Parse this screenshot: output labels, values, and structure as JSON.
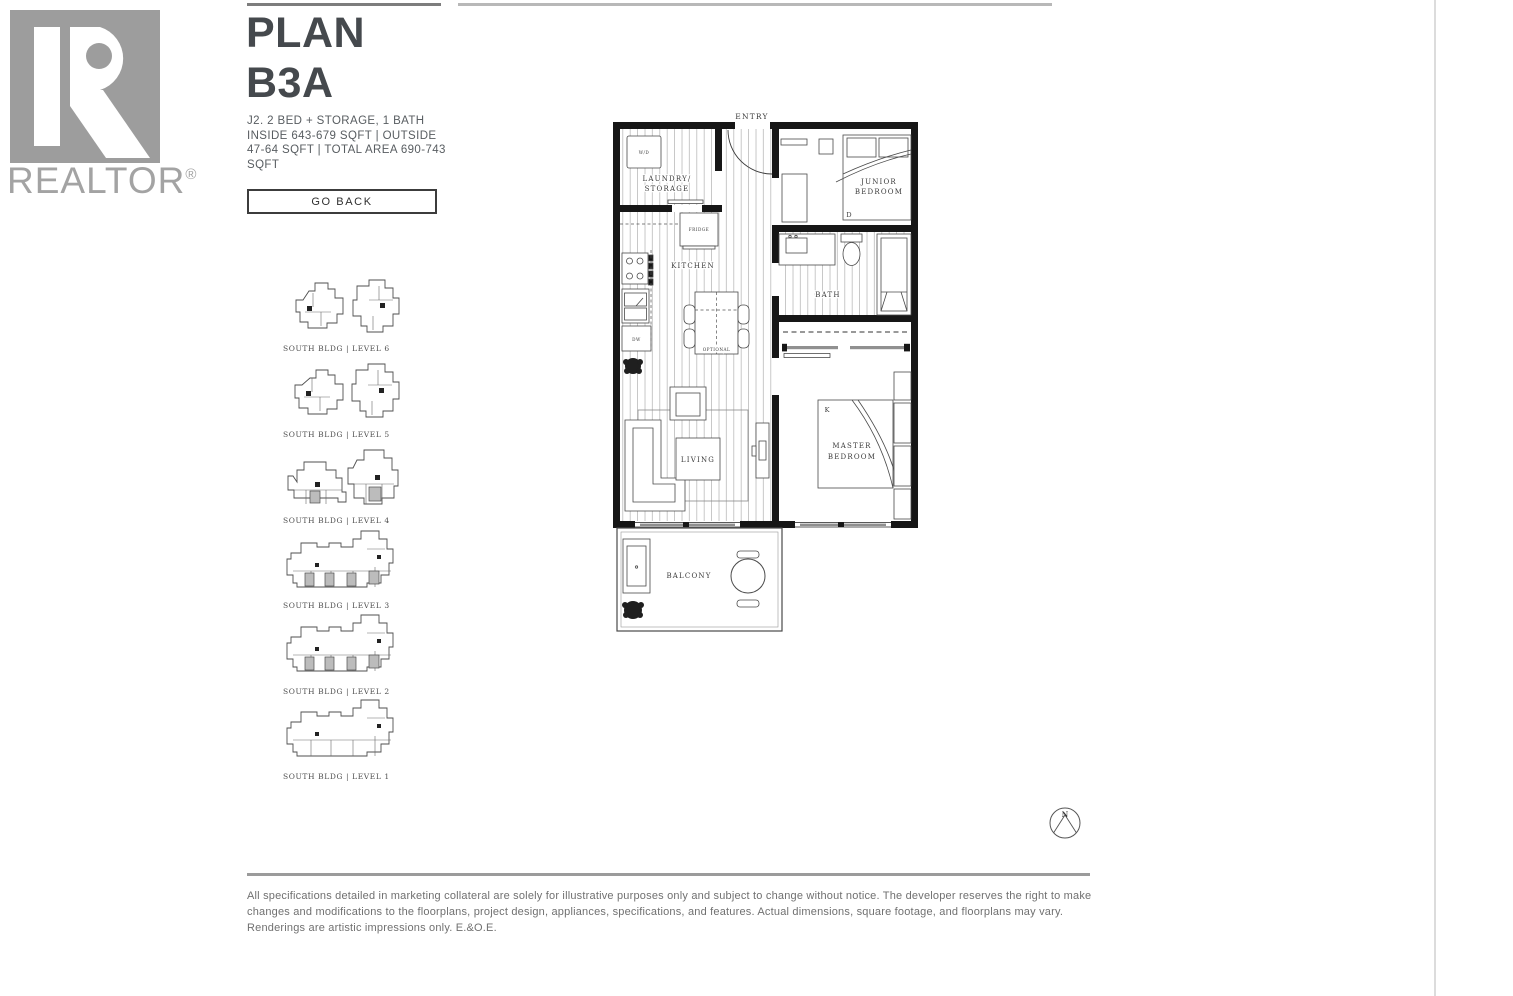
{
  "brand": {
    "logo_text": "REALTOR",
    "logo_reg": "®"
  },
  "plan": {
    "title_line1": "PLAN",
    "title_line2": "B3A",
    "spec_line1": "J2. 2 BED + STORAGE, 1 BATH",
    "spec_line2": "INSIDE 643-679 SQFT | OUTSIDE 47-64 SQFT | TOTAL AREA 690-743 SQFT",
    "go_back": "GO BACK"
  },
  "levels": [
    {
      "label": "SOUTH BLDG | LEVEL 6"
    },
    {
      "label": "SOUTH BLDG | LEVEL 5"
    },
    {
      "label": "SOUTH BLDG | LEVEL 4"
    },
    {
      "label": "SOUTH BLDG | LEVEL 3"
    },
    {
      "label": "SOUTH BLDG | LEVEL 2"
    },
    {
      "label": "SOUTH BLDG | LEVEL 1"
    }
  ],
  "floorplan": {
    "entry": "ENTRY",
    "laundry1": "LAUNDRY/",
    "laundry2": "STORAGE",
    "wd": "W/D",
    "fridge": "FRIDGE",
    "kitchen": "KITCHEN",
    "dw": "DW",
    "optional": "OPTIONAL",
    "junior1": "JUNIOR",
    "junior2": "BEDROOM",
    "door_d": "D",
    "bath": "BATH",
    "living": "LIVING",
    "bed_k": "K",
    "master1": "MASTER",
    "master2": "BEDROOM",
    "balcony": "BALCONY",
    "compass": "N"
  },
  "footer": {
    "disclaimer": "All specifications detailed in marketing collateral are solely for illustrative purposes only and subject to change without notice. The developer reserves the right to make changes and modifications to the floorplans, project design, appliances, specifications, and features. Actual dimensions, square footage, and floorplans may vary. Renderings are artistic impressions only. E.&O.E."
  }
}
